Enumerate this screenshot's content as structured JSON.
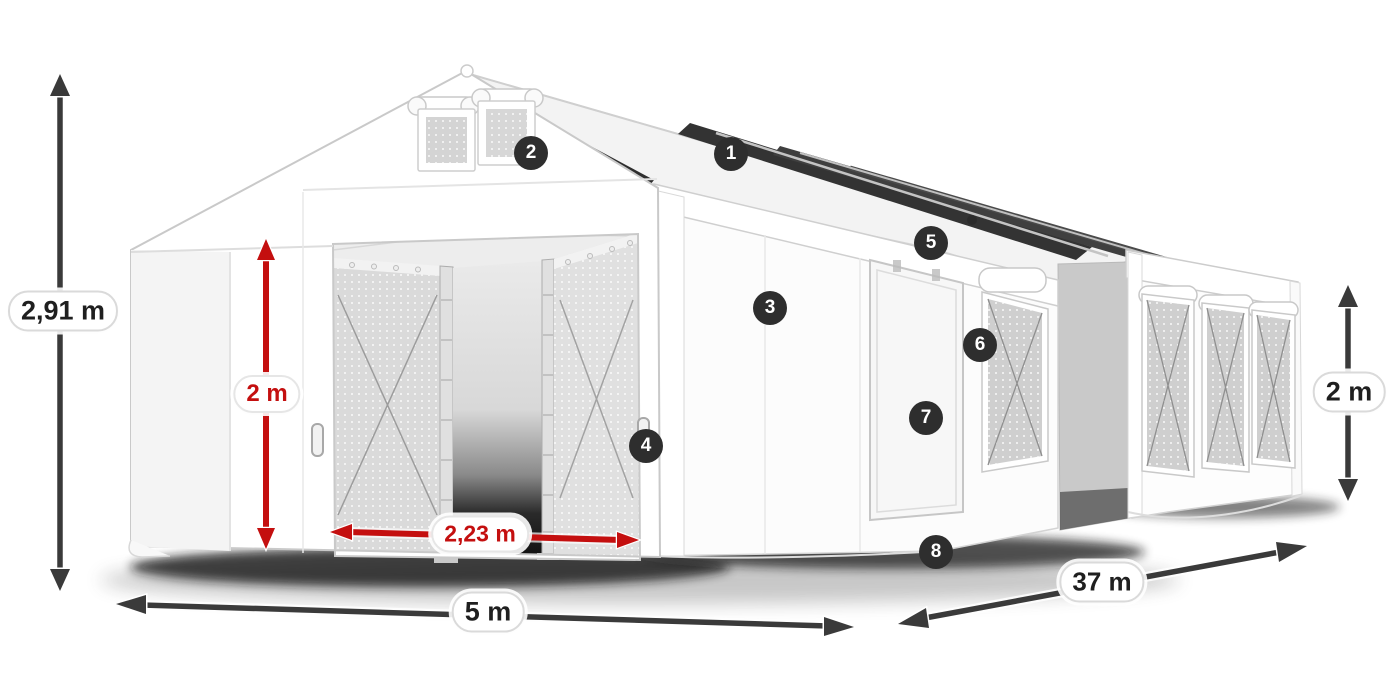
{
  "canvas": {
    "width": 1400,
    "height": 700,
    "background": "#ffffff"
  },
  "illustration": {
    "subject": "white storage tent 3d product diagram",
    "tent_color": "#ffffff",
    "accent_red": "#c40f0f",
    "arrow_dark": "#3a3a3a",
    "badge_bg": "#2e2e2e",
    "badge_text_color": "#ffffff"
  },
  "badges": [
    {
      "number": "1",
      "x": 731,
      "y": 154
    },
    {
      "number": "2",
      "x": 531,
      "y": 153
    },
    {
      "number": "3",
      "x": 770,
      "y": 308
    },
    {
      "number": "4",
      "x": 646,
      "y": 446
    },
    {
      "number": "5",
      "x": 931,
      "y": 243
    },
    {
      "number": "6",
      "x": 980,
      "y": 345
    },
    {
      "number": "7",
      "x": 926,
      "y": 418
    },
    {
      "number": "8",
      "x": 936,
      "y": 552
    }
  ],
  "dimensions": [
    {
      "id": "total-height",
      "label": "2,91 m",
      "style": "dark",
      "x": 63,
      "y": 311,
      "font": 27
    },
    {
      "id": "entrance-height",
      "label": "2 m",
      "style": "red",
      "x": 267,
      "y": 394,
      "font": 24
    },
    {
      "id": "entrance-width",
      "label": "2,23 m",
      "style": "red",
      "x": 480,
      "y": 534,
      "font": 23
    },
    {
      "id": "tent-width",
      "label": "5 m",
      "style": "dark",
      "x": 488,
      "y": 612,
      "font": 27
    },
    {
      "id": "tent-length",
      "label": "37 m",
      "style": "dark",
      "x": 1102,
      "y": 582,
      "font": 26
    },
    {
      "id": "side-height",
      "label": "2 m",
      "style": "dark",
      "x": 1349,
      "y": 392,
      "font": 27
    }
  ]
}
